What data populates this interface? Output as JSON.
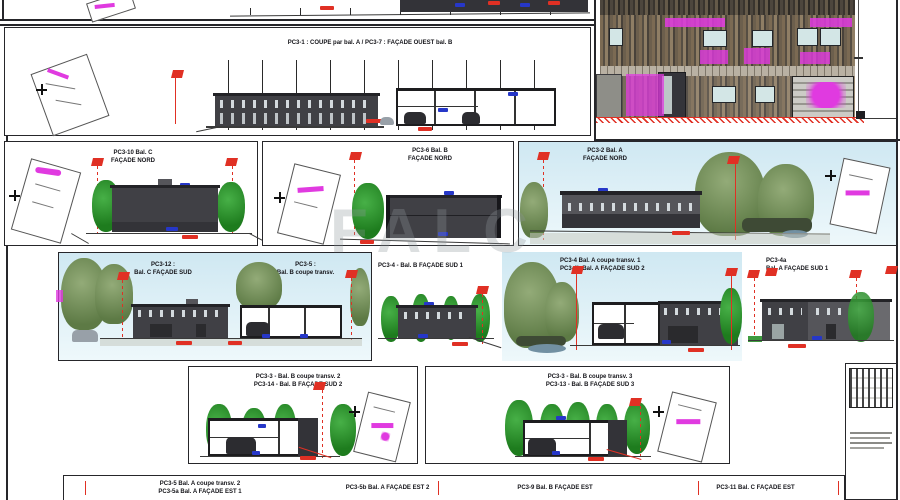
{
  "watermark": "FALC",
  "row1": {
    "title": "PC3-1 : COUPE par bal. A  /  PC3-7 : FAÇADE OUEST bal. B"
  },
  "row2": {
    "panel_c": {
      "line1": "PC3-10 Bal. C",
      "line2": "FAÇADE NORD"
    },
    "panel_b": {
      "line1": "PC3-6 Bal. B",
      "line2": "FAÇADE NORD"
    },
    "panel_a": {
      "line1": "PC3-2 Bal. A",
      "line2": "FAÇADE NORD"
    }
  },
  "row3": {
    "sud_c": {
      "line1": "PC3-12 :",
      "line2": "Bal. C FAÇADE SUD"
    },
    "coupe_b": {
      "line1": "PC3-5 :",
      "line2": "Bal. B coupe transv."
    },
    "sud_b1": {
      "line1": "PC3-4 - Bal. B FAÇADE SUD 1"
    },
    "sud_a2": {
      "line1": "PC3-4 Bal. A coupe transv. 1",
      "line2": "PC3-4b Bal. A FAÇADE SUD 2"
    },
    "sud_a1": {
      "line1": "PC3-4a",
      "line2": "Bal. A FAÇADE SUD 1"
    }
  },
  "row4": {
    "sud_b2": {
      "line1": "PC3-3 - Bal. B coupe transv. 2",
      "line2": "PC3-14 - Bal. B FAÇADE SUD 2"
    },
    "sud_b3": {
      "line1": "PC3-3 - Bal. B coupe transv. 3",
      "line2": "PC3-13 - Bal. B FAÇADE SUD 3"
    }
  },
  "bottom": {
    "t1": {
      "line1": "PC3-5 Bal. A coupe transv. 2",
      "line2": "PC3-5a Bal. A FAÇADE EST 1"
    },
    "t2": {
      "line1": "PC3-5b Bal. A FAÇADE EST 2"
    },
    "t3": {
      "line1": "PC3-9 Bal. B FAÇADE EST"
    },
    "t4": {
      "line1": "PC3-11 Bal. C FAÇADE EST"
    }
  },
  "colors": {
    "annotation_red": "#e03024",
    "annotation_magenta": "#e03ae0",
    "annotation_blue": "#2637c8",
    "building_dark": "#404045",
    "sky": "#cfe8f2",
    "tree_green": "#1e7c1e"
  }
}
